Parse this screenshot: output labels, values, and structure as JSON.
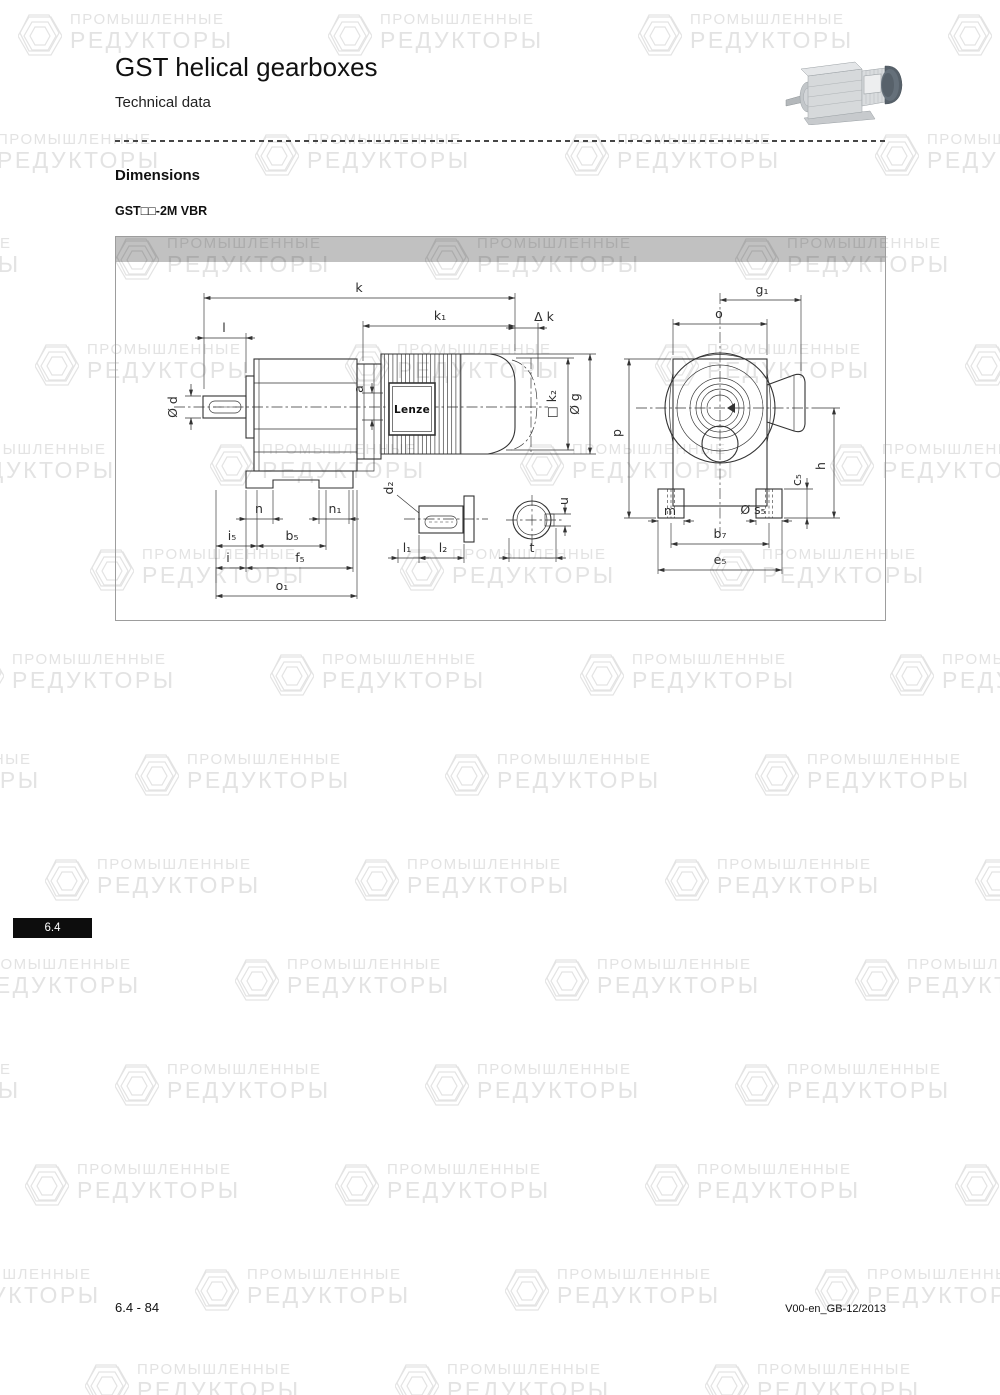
{
  "header": {
    "title": "GST helical gearboxes",
    "subtitle": "Technical data"
  },
  "section": {
    "heading": "Dimensions",
    "model_label": "GST□□-2M VBR"
  },
  "drawing": {
    "brand_label": "Lenze",
    "labels": {
      "k": "k",
      "k1": "k₁",
      "dk": "Δ k",
      "l": "l",
      "d": "Ø d",
      "a": "a",
      "k2": "□ k₂",
      "g": "Ø g",
      "g1": "g₁",
      "o": "o",
      "p": "p",
      "h": "h",
      "c5": "c₅",
      "n": "n",
      "n1": "n₁",
      "i5": "i₅",
      "b5": "b₅",
      "i": "i",
      "f5": "f₅",
      "o1": "o₁",
      "d2": "d₂",
      "l1": "l₁",
      "l2": "l₂",
      "u": "u",
      "t": "t",
      "m": "m",
      "s5": "Ø s₅",
      "b7": "b₇",
      "e5": "e₅"
    }
  },
  "side_tab": {
    "label": "6.4"
  },
  "footer": {
    "page_ref": "6.4 - 84",
    "doc_ref": "V00-en_GB-12/2013"
  },
  "watermark": {
    "line1": "ПРОМЫШЛЕННЫЕ",
    "line2": "РЕДУКТОРЫ"
  },
  "colors": {
    "drawing_header_bar": "#c1c1c1",
    "tab_bg": "#0d0d0d",
    "line": "#333333",
    "watermark": "#e3e3e3"
  }
}
